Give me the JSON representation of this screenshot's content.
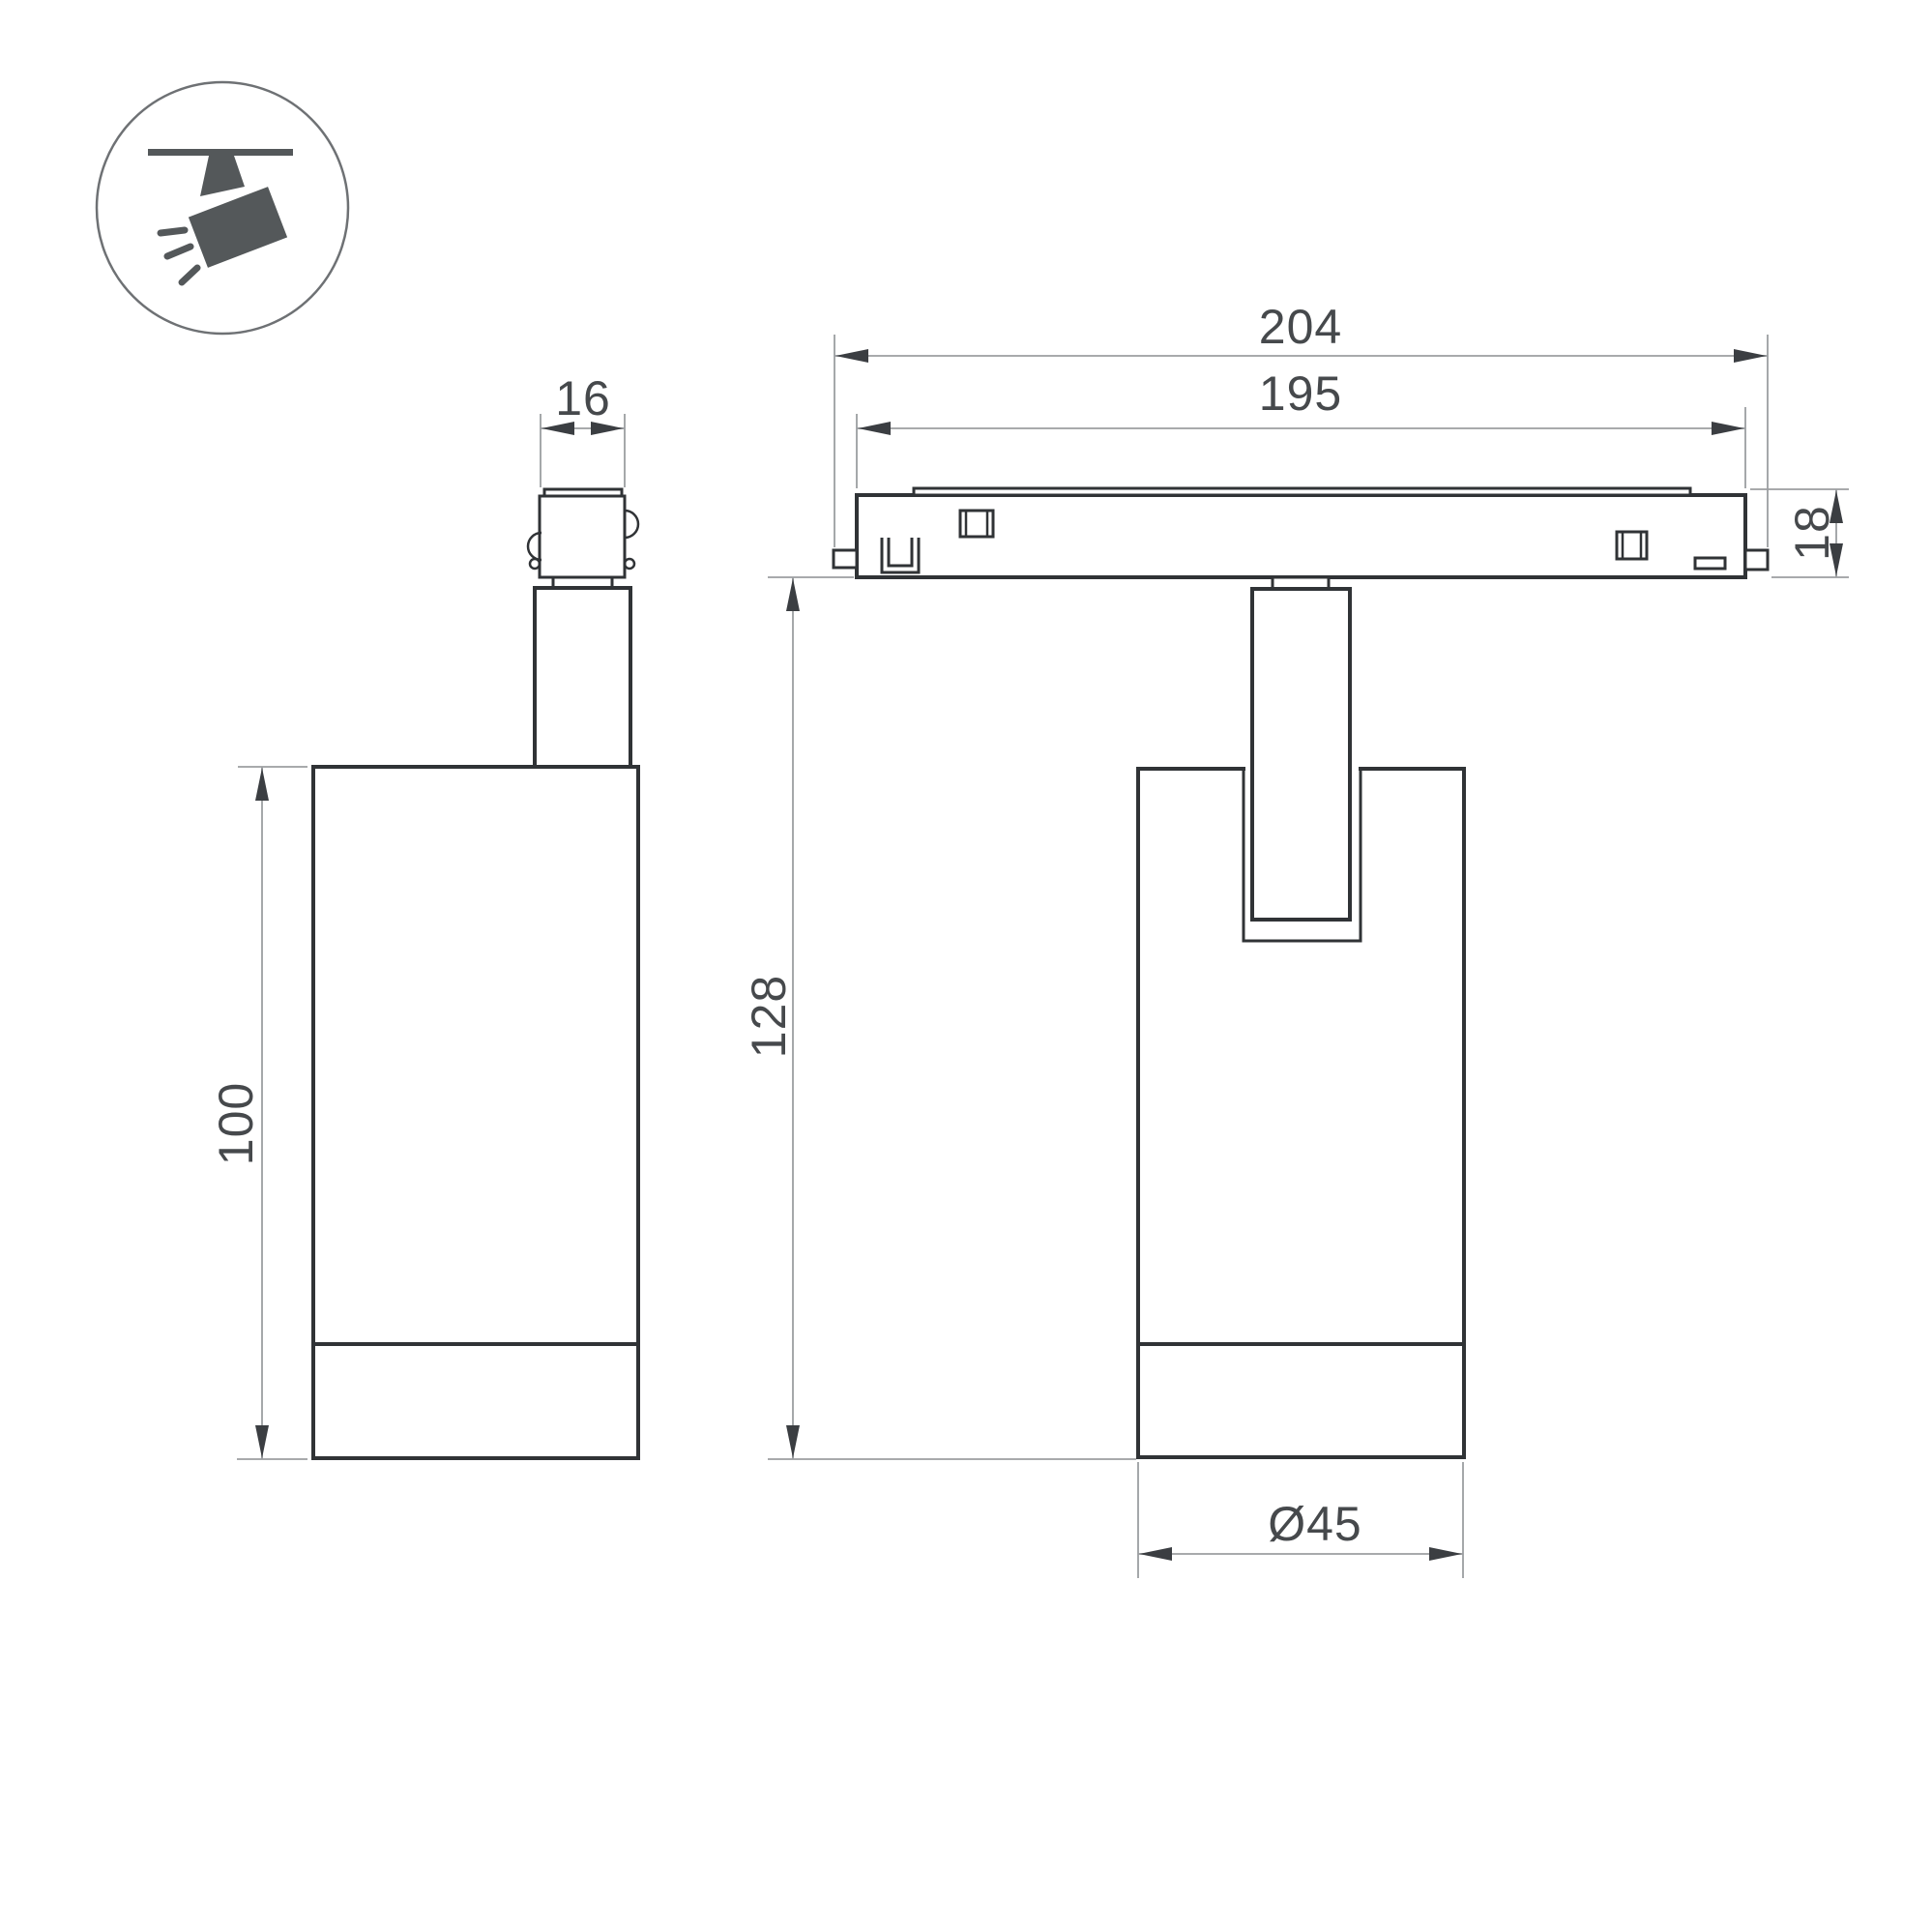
{
  "drawing": {
    "title": "Track spotlight dimension drawing",
    "icon": "ceiling-track-spotlight-pictogram",
    "views": [
      {
        "name": "side-view",
        "dimensions_shown": [
          "16",
          "100"
        ]
      },
      {
        "name": "front-view",
        "dimensions_shown": [
          "204",
          "195",
          "18",
          "128",
          "Ø45"
        ]
      }
    ]
  },
  "dimensions": {
    "connector_width": {
      "label": "16",
      "value": 16
    },
    "body_height": {
      "label": "100",
      "value": 100
    },
    "track_length_outer": {
      "label": "204",
      "value": 204
    },
    "track_length_inner": {
      "label": "195",
      "value": 195
    },
    "track_height": {
      "label": "18",
      "value": 18
    },
    "overall_drop_height": {
      "label": "128",
      "value": 128
    },
    "body_diameter": {
      "label": "Ø45",
      "value": 45
    }
  },
  "colors": {
    "background": "#ffffff",
    "outline": "#303336",
    "dimension_line": "#9b9ea1",
    "arrowhead": "#3b3e42",
    "dimension_text": "#46494c",
    "icon_fill": "#54585a",
    "icon_circle_stroke": "#6e7174"
  }
}
